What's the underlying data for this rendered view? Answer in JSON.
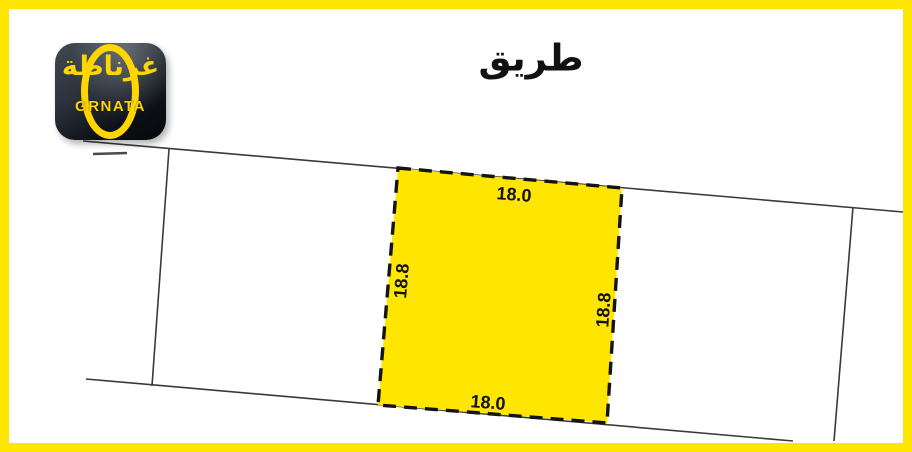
{
  "page": {
    "background_color": "#ffffff",
    "frame_color": "#ffe600",
    "line_color": "#3a3a3a"
  },
  "road": {
    "label": "طريق"
  },
  "logo": {
    "arabic_name": "غرناطة",
    "latin_name": "GRNATA",
    "background_color": "#10141a",
    "accent_color": "#ffd600"
  },
  "parcel": {
    "fill_color": "#ffe600",
    "border_style": "dashed",
    "dimensions": {
      "top": "18.0",
      "bottom": "18.0",
      "left": "18.8",
      "right": "18.8"
    }
  }
}
